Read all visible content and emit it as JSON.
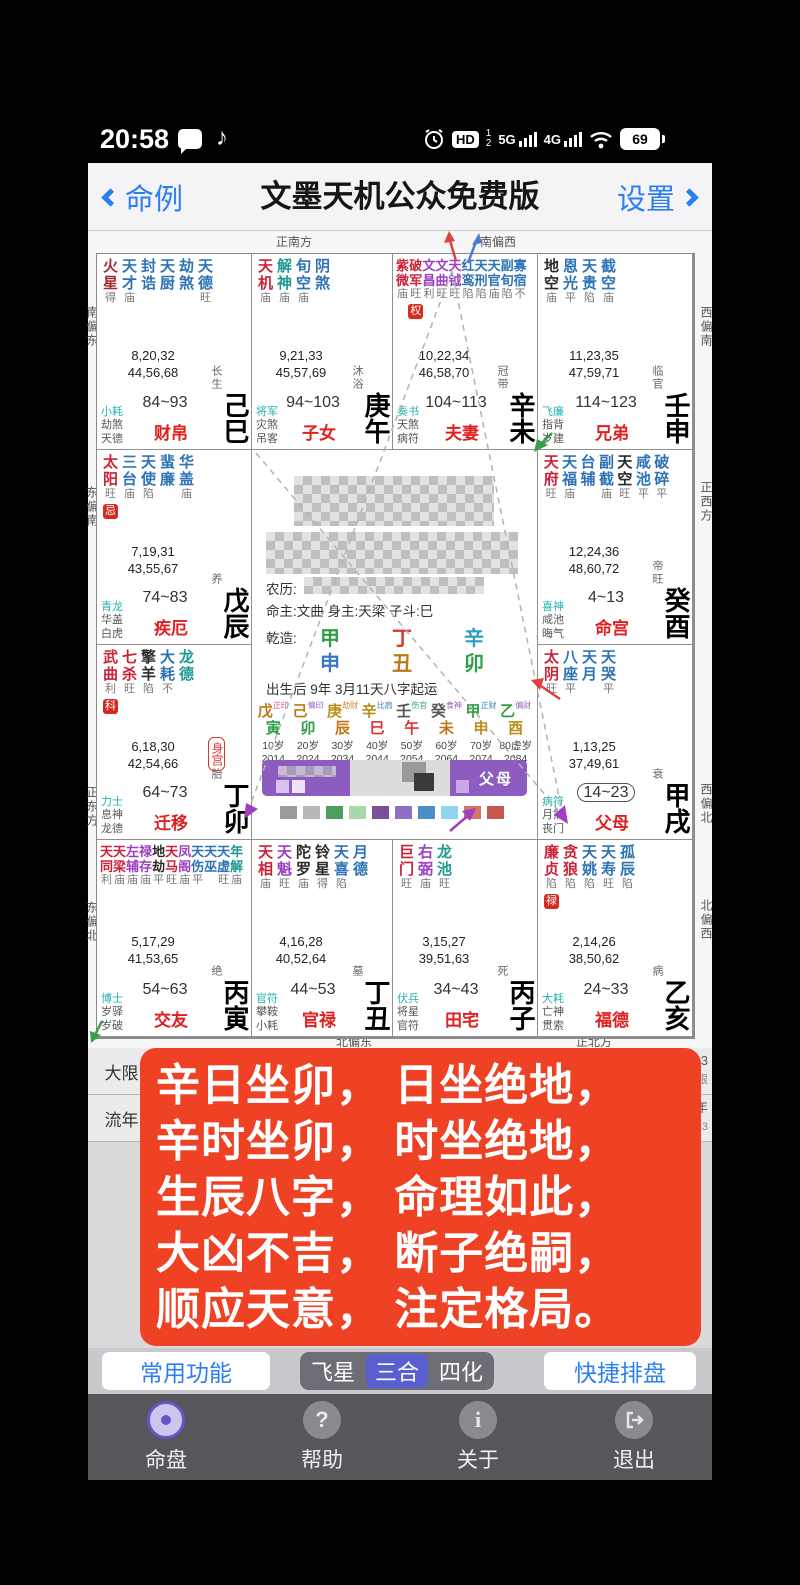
{
  "status_bar": {
    "time": "20:58",
    "hd": "HD",
    "sim1": "1",
    "sim1_net": "5G",
    "sim2": "2",
    "sim2_net": "4G",
    "battery": "69"
  },
  "header": {
    "back": "命例",
    "title": "文墨天机公众免费版",
    "settings": "设置"
  },
  "directions": {
    "top1": "正南方",
    "top2": "南偏西",
    "left1": "南偏东",
    "left2": "东偏南",
    "left3": "正东方",
    "left4": "东偏北",
    "right1": "西偏南",
    "right2": "正西方",
    "right3": "西偏北",
    "right4": "北偏西",
    "bottom1": "北偏东",
    "bottom2": "正北方"
  },
  "chart": {
    "palaces": [
      {
        "area": "r1c1",
        "gz": "己巳",
        "stage": "长生",
        "gods": [
          "小耗",
          "劫煞",
          "天德"
        ],
        "range": "84~93",
        "name": "财帛",
        "numbers": [
          "8,20,32",
          "44,56,68"
        ],
        "stars": [
          [
            "火星",
            "得",
            "fire"
          ],
          [
            "天才",
            "庙",
            "minor"
          ],
          [
            "封诰",
            "",
            "minor"
          ],
          [
            "天厨",
            "",
            "minor"
          ],
          [
            "劫煞",
            "",
            "minor"
          ],
          [
            "天德",
            "旺",
            "minor"
          ]
        ]
      },
      {
        "area": "r1c2",
        "gz": "庚午",
        "stage": "沐浴",
        "gods": [
          "将军",
          "灾煞",
          "吊客"
        ],
        "range": "94~103",
        "name": "子女",
        "numbers": [
          "9,21,33",
          "45,57,69"
        ],
        "stars": [
          [
            "天机",
            "庙",
            "main"
          ],
          [
            "解神",
            "庙",
            "minor2"
          ],
          [
            "旬空",
            "庙",
            "minor"
          ],
          [
            "阴煞",
            "",
            "minor"
          ]
        ]
      },
      {
        "area": "r1c3",
        "gz": "辛未",
        "stage": "冠带",
        "gods": [
          "奏书",
          "天煞",
          "病符"
        ],
        "range": "104~113",
        "name": "夫妻",
        "numbers": [
          "10,22,34",
          "46,58,70"
        ],
        "stars": [
          [
            "紫微",
            "庙",
            "main"
          ],
          [
            "破军",
            "旺",
            "main",
            "权"
          ],
          [
            "文昌",
            "利",
            "aux"
          ],
          [
            "文曲",
            "旺",
            "aux"
          ],
          [
            "天钺",
            "旺",
            "aux"
          ],
          [
            "红鸾",
            "陷",
            "minor"
          ],
          [
            "天刑",
            "陷",
            "minor"
          ],
          [
            "天官",
            "庙",
            "minor"
          ],
          [
            "副旬",
            "陷",
            "minor"
          ],
          [
            "寡宿",
            "不",
            "minor"
          ]
        ]
      },
      {
        "area": "r1c4",
        "gz": "壬申",
        "stage": "临官",
        "gods": [
          "飞廉",
          "指背",
          "岁建"
        ],
        "range": "114~123",
        "name": "兄弟",
        "numbers": [
          "11,23,35",
          "47,59,71"
        ],
        "stars": [
          [
            "地空",
            "庙",
            "sha"
          ],
          [
            "恩光",
            "平",
            "minor"
          ],
          [
            "天贵",
            "陷",
            "minor"
          ],
          [
            "截空",
            "庙",
            "minor"
          ]
        ]
      },
      {
        "area": "r2c1",
        "gz": "戊辰",
        "stage": "养",
        "gods": [
          "青龙",
          "华盖",
          "白虎"
        ],
        "range": "74~83",
        "name": "疾厄",
        "numbers": [
          "7,19,31",
          "43,55,67"
        ],
        "stars": [
          [
            "太阳",
            "旺",
            "main",
            "忌"
          ],
          [
            "三台",
            "庙",
            "minor"
          ],
          [
            "天使",
            "陷",
            "minor"
          ],
          [
            "蜚廉",
            "",
            "minor"
          ],
          [
            "华盖",
            "庙",
            "minor"
          ]
        ]
      },
      {
        "area": "r2c4",
        "gz": "癸酉",
        "stage": "帝旺",
        "gods": [
          "喜神",
          "咸池",
          "晦气"
        ],
        "range": "4~13",
        "name": "命宫",
        "numbers": [
          "12,24,36",
          "48,60,72"
        ],
        "stars": [
          [
            "天府",
            "旺",
            "main"
          ],
          [
            "天福",
            "庙",
            "minor"
          ],
          [
            "台辅",
            "",
            "minor"
          ],
          [
            "副截",
            "庙",
            "minor"
          ],
          [
            "天空",
            "旺",
            "sha"
          ],
          [
            "咸池",
            "平",
            "minor"
          ],
          [
            "破碎",
            "平",
            "minor"
          ]
        ]
      },
      {
        "area": "r3c1",
        "gz": "丁卯",
        "stage": "胎",
        "gods": [
          "力士",
          "息神",
          "龙德"
        ],
        "range": "64~73",
        "name": "迁移",
        "body": true,
        "numbers": [
          "6,18,30",
          "42,54,66"
        ],
        "stars": [
          [
            "武曲",
            "利",
            "main",
            "科"
          ],
          [
            "七杀",
            "旺",
            "main"
          ],
          [
            "擎羊",
            "陷",
            "sha"
          ],
          [
            "大耗",
            "不",
            "minor"
          ],
          [
            "龙德",
            "",
            "minor2"
          ]
        ]
      },
      {
        "area": "r3c4",
        "gz": "甲戌",
        "stage": "衰",
        "gods": [
          "病符",
          "月煞",
          "丧门"
        ],
        "range": "14~23",
        "boxed": true,
        "name": "父母",
        "numbers": [
          "1,13,25",
          "37,49,61"
        ],
        "stars": [
          [
            "太阴",
            "旺",
            "main"
          ],
          [
            "八座",
            "平",
            "minor"
          ],
          [
            "天月",
            "",
            "minor"
          ],
          [
            "天哭",
            "平",
            "minor"
          ]
        ]
      },
      {
        "area": "r4c1",
        "gz": "丙寅",
        "stage": "绝",
        "gods": [
          "博士",
          "岁驿",
          "岁破"
        ],
        "range": "54~63",
        "name": "交友",
        "numbers": [
          "5,17,29",
          "41,53,65"
        ],
        "stars": [
          [
            "天同",
            "利",
            "main"
          ],
          [
            "天梁",
            "庙",
            "main"
          ],
          [
            "左辅",
            "庙",
            "aux"
          ],
          [
            "禄存",
            "庙",
            "aux"
          ],
          [
            "地劫",
            "平",
            "sha"
          ],
          [
            "天马",
            "旺",
            "main"
          ],
          [
            "凤阁",
            "庙",
            "aux"
          ],
          [
            "天伤",
            "平",
            "minor"
          ],
          [
            "天巫",
            "",
            "minor"
          ],
          [
            "天虚",
            "旺",
            "minor"
          ],
          [
            "年解",
            "庙",
            "minor2"
          ]
        ]
      },
      {
        "area": "r4c2",
        "gz": "丁丑",
        "stage": "墓",
        "gods": [
          "官符",
          "攀鞍",
          "小耗"
        ],
        "range": "44~53",
        "name": "官禄",
        "numbers": [
          "4,16,28",
          "40,52,64"
        ],
        "stars": [
          [
            "天相",
            "庙",
            "main"
          ],
          [
            "天魁",
            "旺",
            "aux"
          ],
          [
            "陀罗",
            "庙",
            "sha"
          ],
          [
            "铃星",
            "得",
            "sha"
          ],
          [
            "天喜",
            "陷",
            "minor"
          ],
          [
            "月德",
            "",
            "minor"
          ]
        ]
      },
      {
        "area": "r4c3",
        "gz": "丙子",
        "stage": "死",
        "gods": [
          "伏兵",
          "将星",
          "官符"
        ],
        "range": "34~43",
        "name": "田宅",
        "numbers": [
          "3,15,27",
          "39,51,63"
        ],
        "stars": [
          [
            "巨门",
            "旺",
            "main"
          ],
          [
            "右弼",
            "庙",
            "aux"
          ],
          [
            "龙池",
            "旺",
            "minor2"
          ]
        ]
      },
      {
        "area": "r4c4",
        "gz": "乙亥",
        "stage": "病",
        "gods": [
          "大耗",
          "亡神",
          "贯索"
        ],
        "range": "24~33",
        "name": "福德",
        "numbers": [
          "2,14,26",
          "38,50,62"
        ],
        "stars": [
          [
            "廉贞",
            "陷",
            "main",
            "禄"
          ],
          [
            "贪狼",
            "陷",
            "main"
          ],
          [
            "天姚",
            "陷",
            "minor"
          ],
          [
            "天寿",
            "旺",
            "minor"
          ],
          [
            "孤辰",
            "陷",
            "minor"
          ]
        ]
      }
    ]
  },
  "center": {
    "lunar_label": "农历:",
    "masters": "命主:文曲 身主:天梁 子斗:巳",
    "qianzao_label": "乾造:",
    "pillars": [
      {
        "stem": "甲",
        "sc": "#2f9e44",
        "branch": "申",
        "bc": "#3b76c0"
      },
      {
        "stem": "丁",
        "sc": "#e03131",
        "branch": "丑",
        "bc": "#c07818"
      },
      {
        "stem": "辛",
        "sc": "#2b9fbf",
        "branch": "卯",
        "bc": "#2f9e44"
      },
      {
        "stem": "辛",
        "sc": "#2b9fbf",
        "branch": "卯",
        "bc": "#2f9e44"
      }
    ],
    "qiyun": "出生后 9年 3月11天八字起运",
    "dayun": [
      {
        "stem": "戊",
        "god": "正印",
        "branch": "寅",
        "age": "10岁",
        "year": "2014",
        "sc": "#c07818",
        "bc": "#2f9e44",
        "gc": "#e0557a"
      },
      {
        "stem": "己",
        "god": "偏印",
        "branch": "卯",
        "age": "20岁",
        "year": "2024",
        "sc": "#c07818",
        "bc": "#2f9e44",
        "gc": "#9a5fc0"
      },
      {
        "stem": "庚",
        "god": "劫财",
        "branch": "辰",
        "age": "30岁",
        "year": "2034",
        "sc": "#b89018",
        "bc": "#c07818",
        "gc": "#d08030"
      },
      {
        "stem": "辛",
        "god": "比肩",
        "branch": "巳",
        "age": "40岁",
        "year": "2044",
        "sc": "#b89018",
        "bc": "#e03131",
        "gc": "#4080c0"
      },
      {
        "stem": "壬",
        "god": "伤官",
        "branch": "午",
        "age": "50岁",
        "year": "2054",
        "sc": "#555555",
        "bc": "#e03131",
        "gc": "#30a080"
      },
      {
        "stem": "癸",
        "god": "食神",
        "branch": "未",
        "age": "60岁",
        "year": "2064",
        "sc": "#555555",
        "bc": "#c07818",
        "gc": "#9a5fc0"
      },
      {
        "stem": "甲",
        "god": "正财",
        "branch": "申",
        "age": "70岁",
        "year": "2074",
        "sc": "#2f9e44",
        "bc": "#b89018",
        "gc": "#4080c0"
      },
      {
        "stem": "乙",
        "god": "偏财",
        "branch": "酉",
        "age": "80虚岁",
        "year": "2084",
        "sc": "#2f9e44",
        "bc": "#b89018",
        "gc": "#9a5fc0"
      }
    ],
    "selector_right": "父母",
    "legend_squares": [
      "#9c9c9c",
      "#b8b8b8",
      "#4e9e5e",
      "#a9d8a9",
      "#7b4f9b",
      "#8f6fc5",
      "#4a8fc8",
      "#8fd4f0",
      "#d4756a",
      "#c6574e"
    ]
  },
  "daxian_row": {
    "label": "大限",
    "fragment_top": "94~103",
    "fragment_bottom": "庚午限"
  },
  "liunian_row": {
    "label": "流年",
    "fragment_top": "2018年",
    "fragment_bottom": "丙申13"
  },
  "overlay": {
    "color": "#ef4123",
    "lines": [
      "辛日坐卯， 日坐绝地，",
      "辛时坐卯， 时坐绝地，",
      "生辰八字， 命理如此，",
      "大凶不吉， 断子绝嗣，",
      "顺应天意， 注定格局。"
    ]
  },
  "toolbar": {
    "left": "常用功能",
    "segments": [
      "飞星",
      "三合",
      "四化"
    ],
    "selected": "三合",
    "right": "快捷排盘"
  },
  "nav": [
    {
      "label": "命盘",
      "icon": "chart-disc-icon"
    },
    {
      "label": "帮助",
      "icon": "question-icon",
      "glyph": "?"
    },
    {
      "label": "关于",
      "icon": "info-icon",
      "glyph": "i"
    },
    {
      "label": "退出",
      "icon": "exit-icon"
    }
  ]
}
